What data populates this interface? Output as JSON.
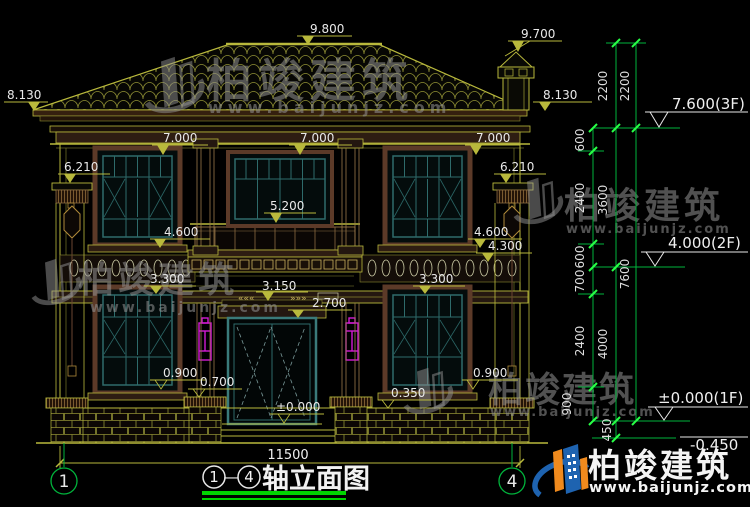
{
  "drawing": {
    "title": {
      "axis_from": "1",
      "dash": "—",
      "axis_to": "4",
      "name": "轴立面图"
    },
    "axis_bubbles": {
      "left": "1",
      "right": "4"
    },
    "overall_width": "11500",
    "levels": {
      "ridge": "9.800",
      "chimney": "9.700",
      "eave_left": "8.130",
      "eave_right": "8.130",
      "cornice_left": "7.000",
      "cornice_mid": "7.000",
      "cornice_right": "7.000",
      "post_left": "6.210",
      "post_right": "6.210",
      "balcony_rail": "5.200",
      "sill2f_left": "4.600",
      "sill2f_right": "4.600",
      "console_right": "4.300",
      "band_left": "3.300",
      "band_right": "3.300",
      "balcony_slab": "3.150",
      "door_head": "2.700",
      "sill1f_left": "0.900",
      "sill1f_right": "0.900",
      "porch": "0.700",
      "plinth": "0.350",
      "threshold": "±0.000"
    },
    "floor_marks": {
      "f3": "7.600(3F)",
      "f2": "4.000(2F)",
      "f1": "±0.000(1F)",
      "foundation": "-0.450"
    },
    "chains": {
      "inner": [
        "600",
        "2400",
        "600",
        "700",
        "2400",
        "900"
      ],
      "middle": [
        "2200",
        "3600",
        "4000",
        "450"
      ],
      "outer": [
        "2200",
        "7600"
      ]
    }
  },
  "watermark": {
    "brand": "柏竣建筑",
    "url": "www.baijunjz.com"
  },
  "logo": {
    "brand": "柏竣建筑",
    "url": "www.baijunjz.com"
  }
}
